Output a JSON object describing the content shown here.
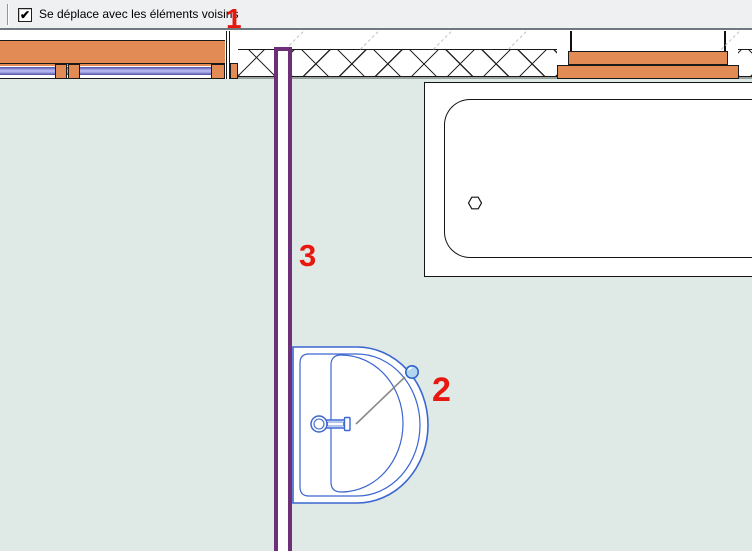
{
  "toolbar": {
    "checkbox": {
      "label": "Se déplace avec les éléments voisins",
      "checked": true,
      "checkmark_glyph": "✔"
    }
  },
  "annotations": [
    {
      "label": "1"
    },
    {
      "label": "2"
    },
    {
      "label": "3"
    }
  ],
  "colors": {
    "annotation_red": "#e8170f",
    "wall_orange": "#e28b55",
    "partition_purple": "#6d3078",
    "fixture_blue": "#3c66d1",
    "drag_handle_fill": "#b3d6f0",
    "glazing_periwinkle": "#9b9be4",
    "room_background": "#dfe9e5",
    "drawing_line": "#1a1a1a",
    "reference_line_gray": "#bcbcbc",
    "leader_line_gray": "#888888"
  }
}
